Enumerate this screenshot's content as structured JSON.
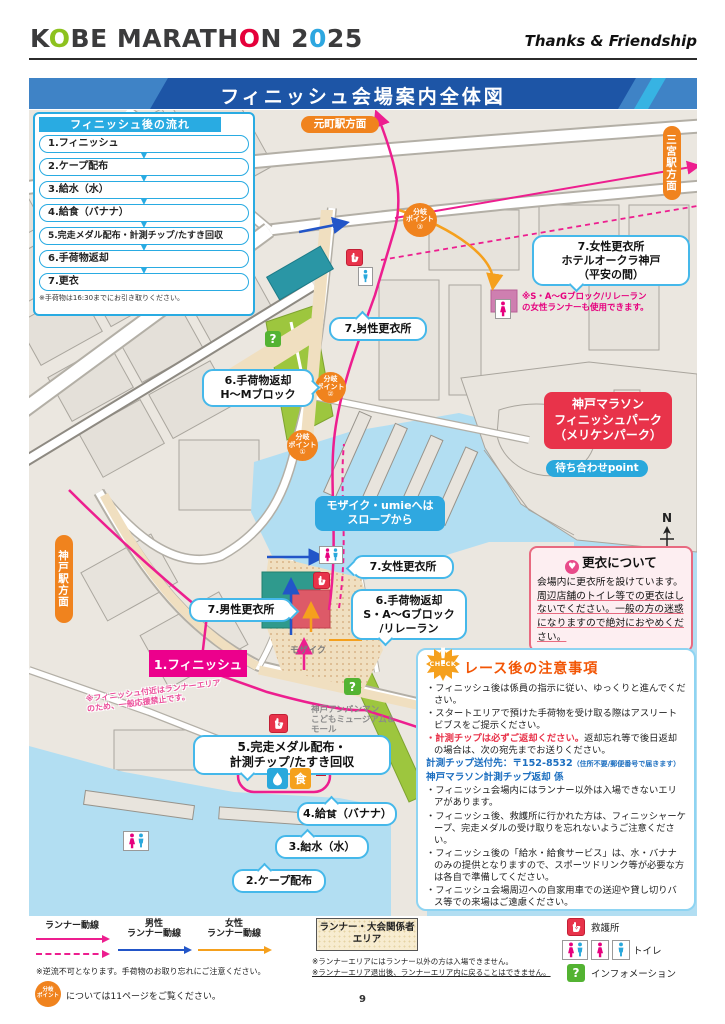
{
  "header": {
    "logo_parts": [
      {
        "text": "K",
        "color": "#3b3b3c"
      },
      {
        "text": "O",
        "color": "#8dc21f"
      },
      {
        "text": "BE MARATH",
        "color": "#3b3b3c"
      },
      {
        "text": "O",
        "color": "#e5003a"
      },
      {
        "text": "N 2",
        "color": "#3b3b3c"
      },
      {
        "text": "0",
        "color": "#2ea7e0"
      },
      {
        "text": "25",
        "color": "#3b3b3c"
      }
    ],
    "tagline": "Thanks & Friendship",
    "banner_title": "フィニッシュ会場案内全体図"
  },
  "flow": {
    "title": "フィニッシュ後の流れ",
    "steps": [
      "1.フィニッシュ",
      "2.ケープ配布",
      "3.給水（水）",
      "4.給食（バナナ）",
      "5.完走メダル配布・計測チップ/たすき回収",
      "6.手荷物返却",
      "7.更衣"
    ],
    "note": "※手荷物は16:30までにお引き取りください。"
  },
  "map": {
    "motomachi": "元町駅方面",
    "sannomiya": "三宮駅方面",
    "kobe_station": "神戸駅方面",
    "branch_label": "分岐\nポイント",
    "branch_nums": [
      "①",
      "②",
      "③"
    ],
    "hotel_callout": "7.女性更衣所\nホテルオークラ神戸\n（平安の間）",
    "hotel_note": "※S・A～Gブロック/リレーラン\nの女性ランナーも使用できます。",
    "male_change_top": "7.男性更衣所",
    "baggage_hm": "6.手荷物返却\nH～Mブロック",
    "finish_park": "神戸マラソン\nフィニッシュパーク\n（メリケンパーク）",
    "meeting_point": "待ち合わせpoint",
    "mosaic_umie": "モザイク・umieへは\nスロープから",
    "female_change": "7.女性更衣所",
    "male_change": "7.男性更衣所",
    "baggage_sag": "6.手荷物返却\nS・A～Gブロック\n/リレーラン",
    "mosaic": "モザイク",
    "finish": "1.フィニッシュ",
    "finish_note": "※フィニッシュ付近はランナーエリア\nのため、一般応援禁止です。",
    "medal": "5.完走メダル配布・\n計測チップ/たすき回収",
    "food": "4.給食（バナナ）",
    "water": "3.給水（水）",
    "cape": "2.ケープ配布",
    "anpanman": "神戸アンパンマン\nこどもミュージアム＆\nモール",
    "north": "N"
  },
  "koi_panel": {
    "title": "更衣について",
    "body1": "会場内に更衣所を設けています。",
    "body2": "周辺店舗のトイレ等での更衣はしないでください。一般の方の迷惑になりますので絶対におやめください。"
  },
  "notes_panel": {
    "check": "CHECK",
    "bang": "!",
    "title": "レース後の注意事項",
    "item1": "・フィニッシュ後は係員の指示に従い、ゆっくりと進んでください。",
    "item2": "・スタートエリアで預けた手荷物を受け取る際はアスリートビブスをご提示ください。",
    "item3_red": "・計測チップは必ずご返却ください。",
    "item3_rest": "返却忘れ等で後日返却の場合は、次の宛先までお送りください。",
    "addr_main": "計測チップ送付先：〒152-8532",
    "addr_small": "（住所不要/郵便番号で届きます）",
    "addr2": "神戸マラソン計測チップ返却 係",
    "item4": "・フィニッシュ会場内にはランナー以外は入場できないエリアがあります。",
    "item5": "・フィニッシュ後、救護所に行かれた方は、フィニッシャーケープ、完走メダルの受け取りを忘れないようご注意ください。",
    "item6": "・フィニッシュ後の「給水・給食サービス」は、水・バナナのみの提供となりますので、スポーツドリンク等が必要な方は各自で準備してください。",
    "item7": "・フィニッシュ会場周辺への自家用車での送迎や貸し切りバス等での来場はご遠慮ください。"
  },
  "legend": {
    "runner_route": "ランナー動線",
    "male_route": "男性\nランナー動線",
    "female_route": "女性\nランナー動線",
    "reverse_note": "※逆流不可となります。手荷物のお取り忘れにご注意ください。",
    "branch_note": "については11ページをご覧ください。",
    "area_box": "ランナー・大会関係者\nエリア",
    "area_note1": "※ランナーエリアにはランナー以外の方は入場できません。",
    "area_note2": "※ランナーエリア退出後、ランナーエリア内に戻ることはできません。",
    "aid_station": "救護所",
    "toilet": "トイレ",
    "information": "インフォメーション"
  },
  "icons": {
    "flow_arrow": "▼",
    "food_glyph": "食",
    "info_glyph": "?",
    "heart_glyph": "♥"
  },
  "colors": {
    "banner_blue": "#1d55a6",
    "light_blue": "#29abe2",
    "orange": "#f0831e",
    "pink_route": "#ed1e8f",
    "male_blue": "#2255c8",
    "female_orange": "#f5a01d",
    "finish_pink": "#ec008c",
    "park_red": "#e8334a",
    "water": "#b2def2",
    "land": "#ebe7e0",
    "green": "#9dc63e"
  },
  "page_number": "9"
}
